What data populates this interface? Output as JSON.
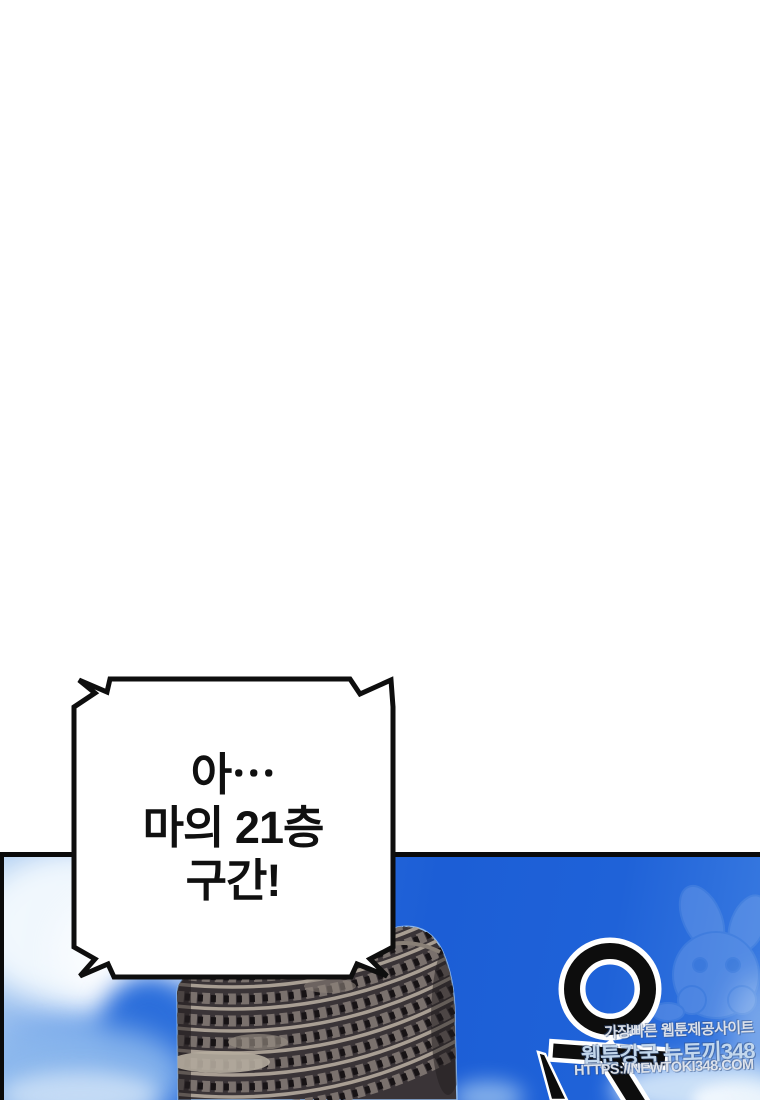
{
  "bubble": {
    "lines": [
      "아⋯",
      "마의 21층",
      "구간!"
    ]
  },
  "panel": {
    "sfx": {
      "text": "우",
      "color": "#0d0d0d",
      "outline_color": "#ffffff"
    },
    "watermark": {
      "tagline": "가장빠른 웹툰제공사이트",
      "site": "웹툰강국 뉴토끼348",
      "url": "HTTPS://NEWTOKI348.COM"
    },
    "colors": {
      "sky_deep": "#1c5ed6",
      "sky_light": "#a9caf0",
      "cloud": "#f4fafe",
      "building_body": "#3a3437",
      "building_rail": "#a89e93",
      "panel_border": "#0a0a0a"
    },
    "building": "colosseum-round-tower"
  }
}
